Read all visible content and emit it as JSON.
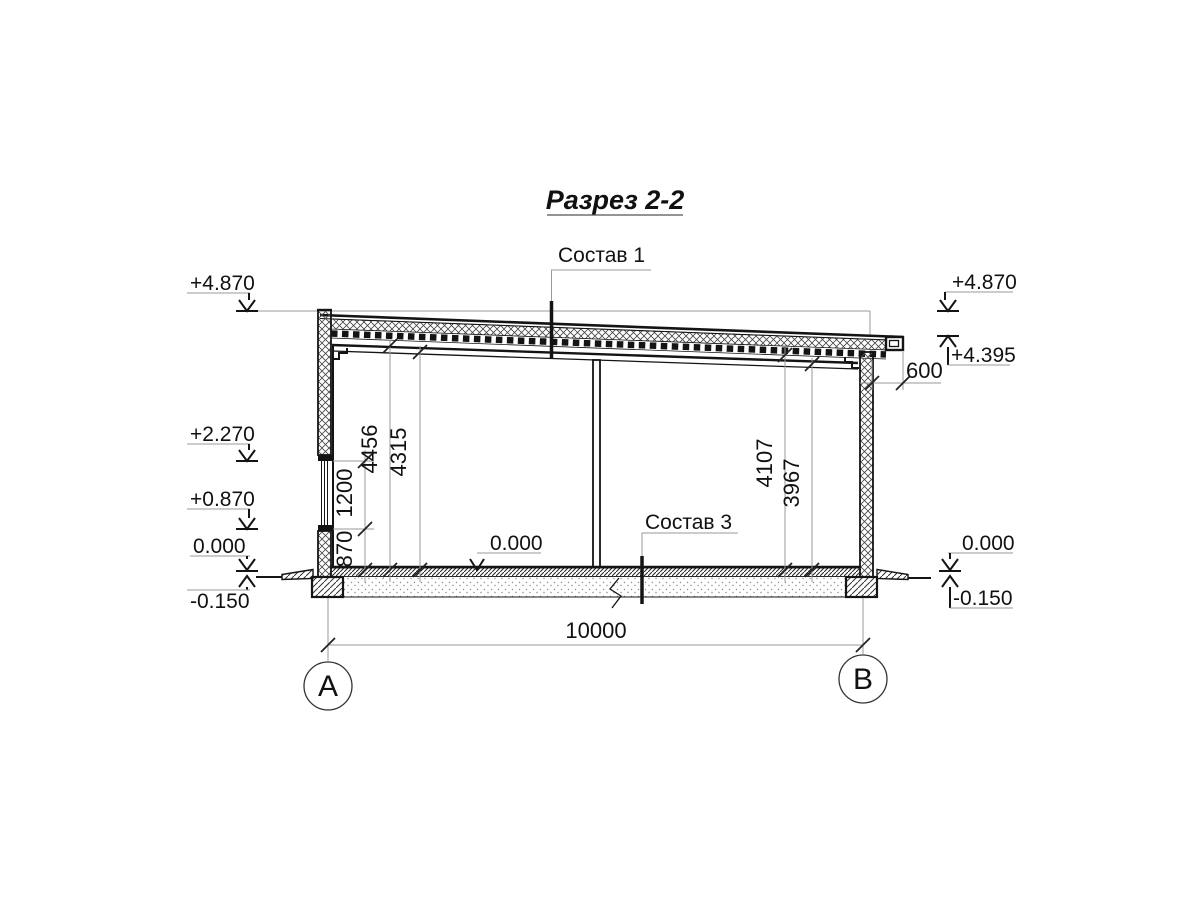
{
  "title": "Разрез 2-2",
  "callouts": {
    "roof_composition": "Состав 1",
    "floor_composition": "Состав 3"
  },
  "elevations": {
    "left_parapet": "+4.870",
    "left_window_head": "+2.270",
    "left_window_sill": "+0.870",
    "left_floor": "0.000",
    "left_ground": "-0.150",
    "right_parapet": "+4.870",
    "right_eave": "+4.395",
    "right_floor": "0.000",
    "right_ground": "-0.150",
    "interior_floor": "0.000"
  },
  "dimensions": {
    "sill_height": "870",
    "window_height": "1200",
    "clear_height_left_upper": "4456",
    "clear_height_left": "4315",
    "clear_height_right_upper": "4107",
    "clear_height_right": "3967",
    "roof_overhang": "600",
    "span": "10000"
  },
  "axes": {
    "left": "А",
    "right": "В"
  },
  "colors": {
    "line": "#141414",
    "construction_line": "#9a9a9a",
    "background": "#ffffff"
  }
}
